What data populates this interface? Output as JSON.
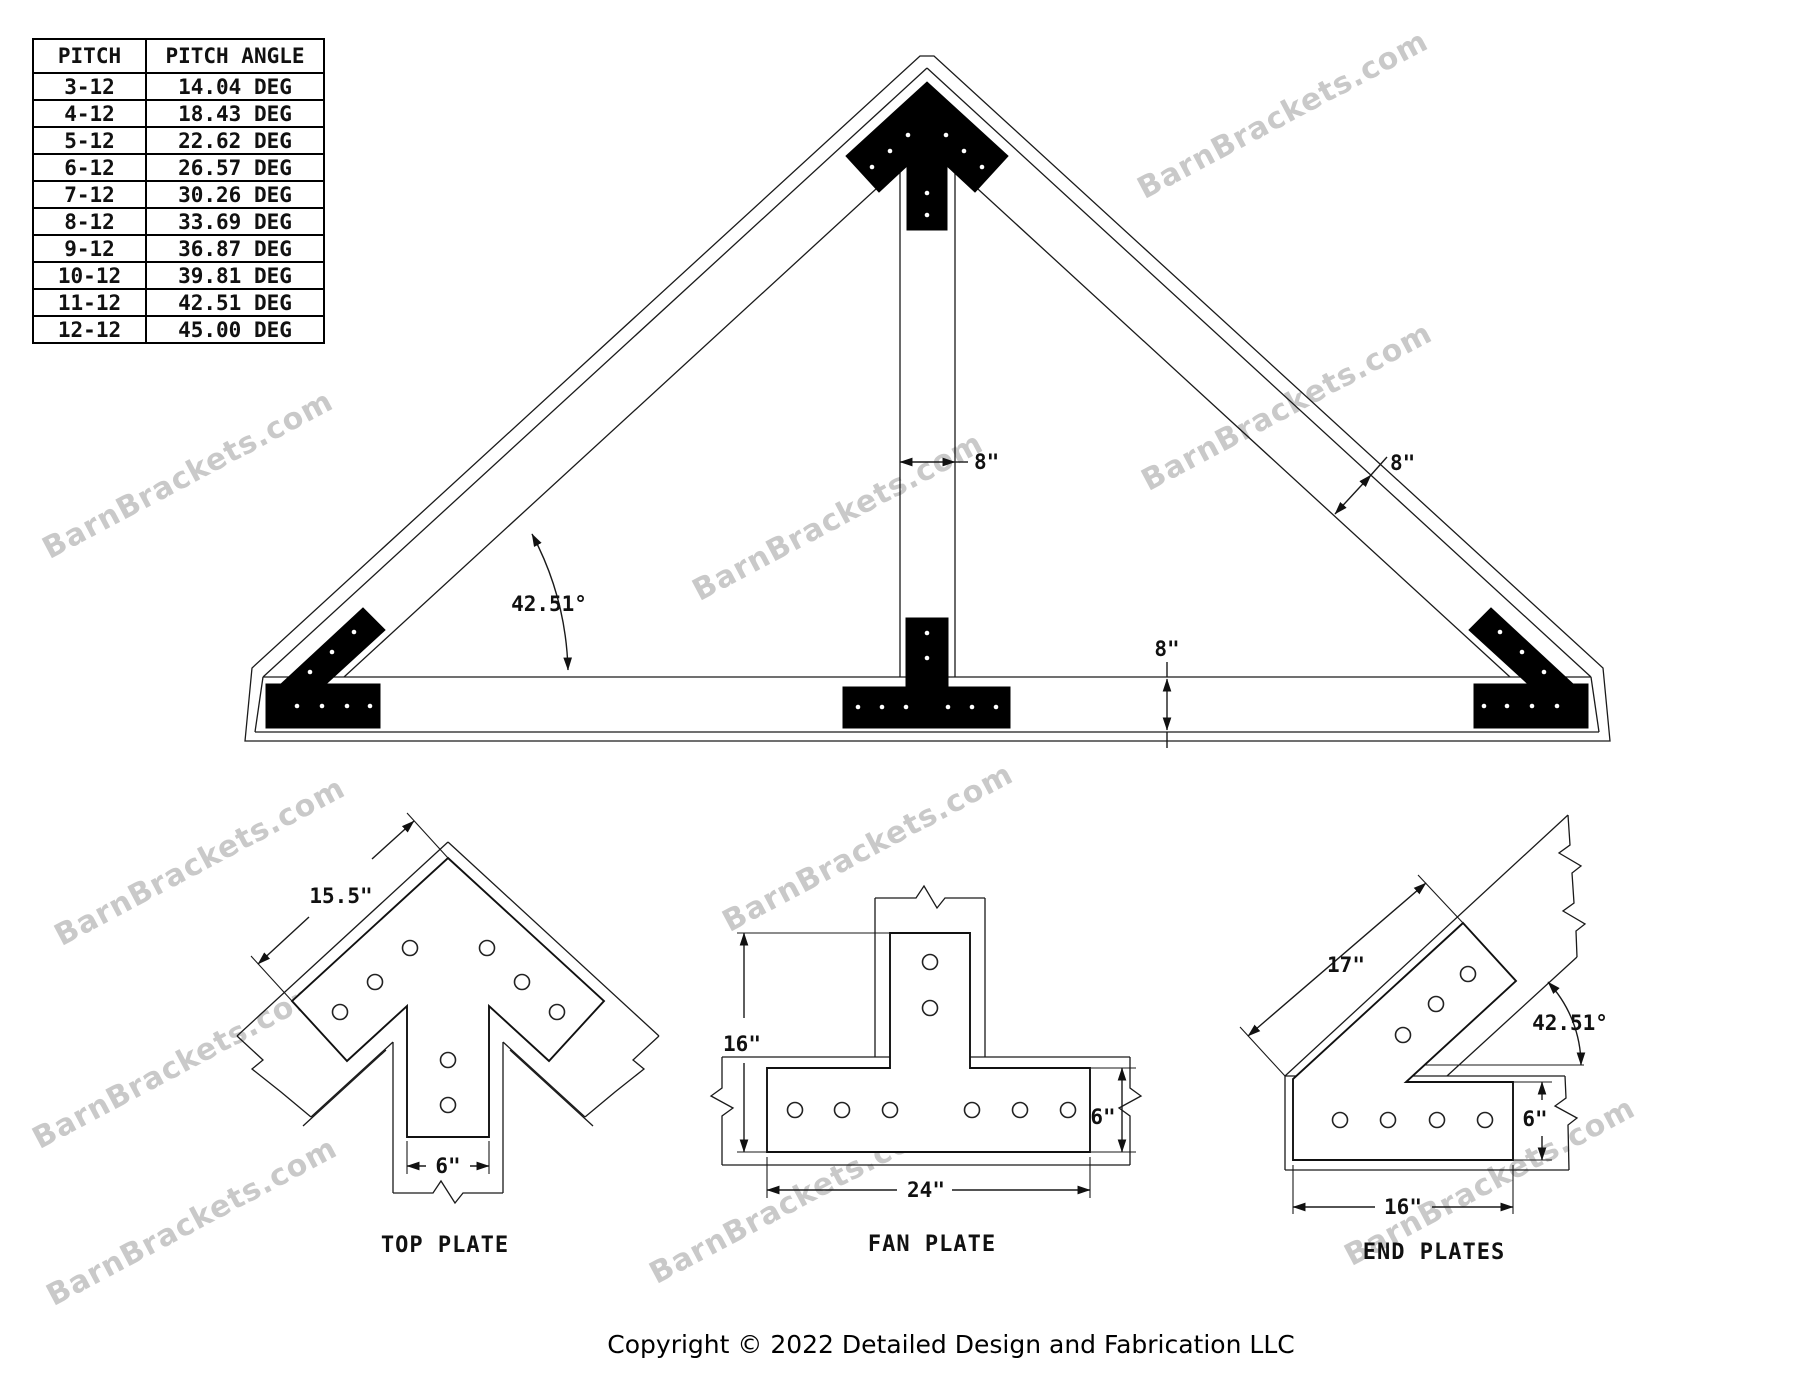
{
  "watermark": {
    "text": "BarnBrackets.com"
  },
  "pitch_table": {
    "headers": [
      "PITCH",
      "PITCH ANGLE"
    ],
    "rows": [
      [
        "3-12",
        "14.04 DEG"
      ],
      [
        "4-12",
        "18.43 DEG"
      ],
      [
        "5-12",
        "22.62 DEG"
      ],
      [
        "6-12",
        "26.57 DEG"
      ],
      [
        "7-12",
        "30.26 DEG"
      ],
      [
        "8-12",
        "33.69 DEG"
      ],
      [
        "9-12",
        "36.87 DEG"
      ],
      [
        "10-12",
        "39.81 DEG"
      ],
      [
        "11-12",
        "42.51 DEG"
      ],
      [
        "12-12",
        "45.00 DEG"
      ]
    ]
  },
  "truss": {
    "king_post_width_label": "8\"",
    "rafter_depth_label": "8\"",
    "chord_depth_label": "8\"",
    "pitch_angle_label": "42.51°"
  },
  "details": {
    "top_plate": {
      "title": "TOP PLATE",
      "edge_length_label": "15.5\"",
      "stem_width_label": "6\""
    },
    "fan_plate": {
      "title": "FAN PLATE",
      "height_label": "16\"",
      "bar_height_label": "6\"",
      "width_label": "24\""
    },
    "end_plates": {
      "title": "END PLATES",
      "diagonal_length_label": "17\"",
      "angle_label": "42.51°",
      "bar_height_label": "6\"",
      "bar_length_label": "16\""
    }
  },
  "footer": {
    "copyright": "Copyright © 2022 Detailed Design and Fabrication LLC"
  }
}
